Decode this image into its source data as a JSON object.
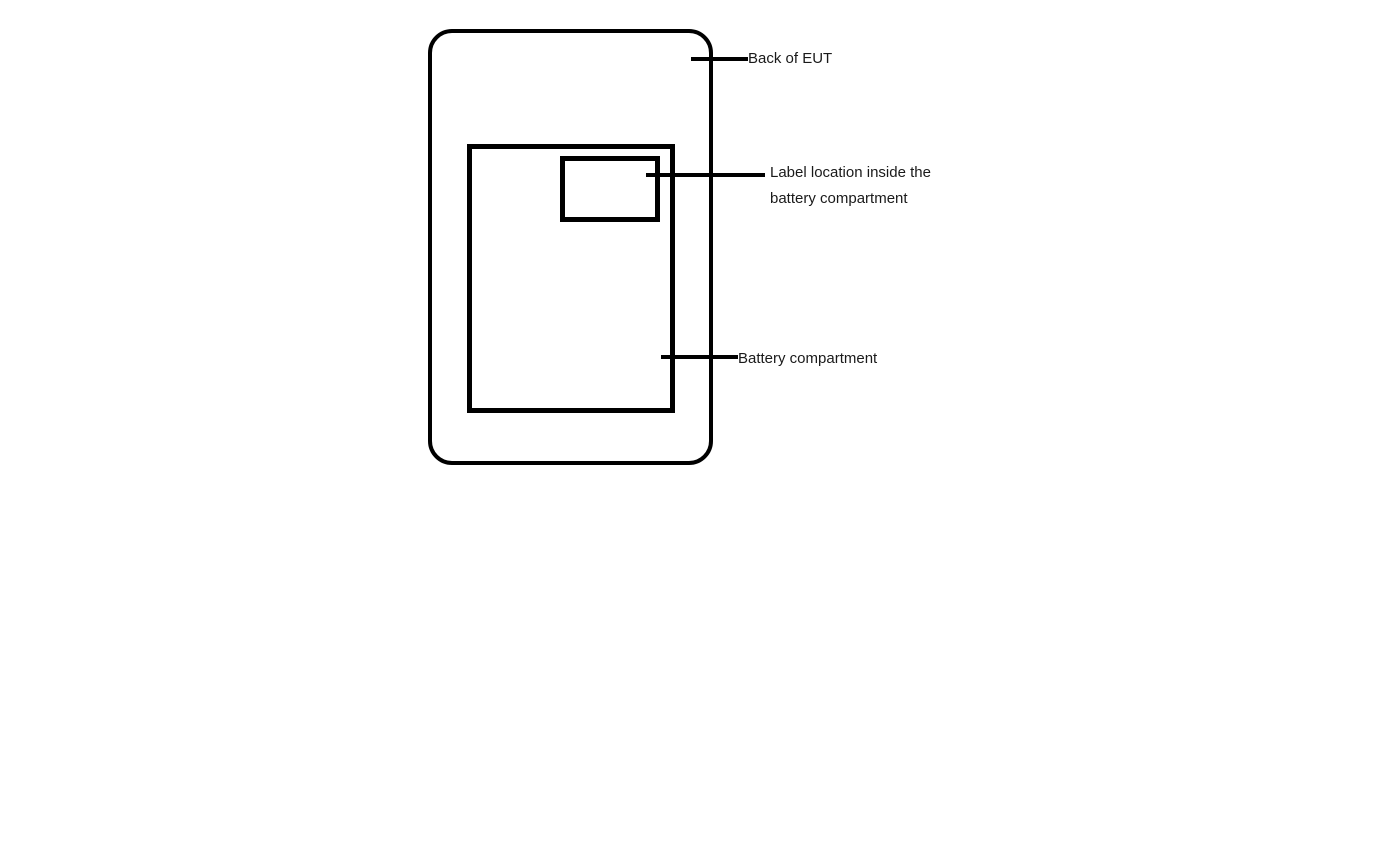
{
  "diagram": {
    "title": "EUT label location diagram",
    "background_color": "#ffffff",
    "line_color": "#000000",
    "text_color": "#1a1a1a",
    "shapes": {
      "back_of_eut_outline": "rounded rectangle",
      "battery_compartment_rect": "rectangle",
      "label_location_rect": "rectangle"
    },
    "callouts": {
      "back_of_eut": {
        "text": "Back of EUT"
      },
      "label_location": {
        "line1": "Label location inside the",
        "line2": "battery compartment"
      },
      "battery_compartment": {
        "text": "Battery compartment"
      }
    }
  }
}
